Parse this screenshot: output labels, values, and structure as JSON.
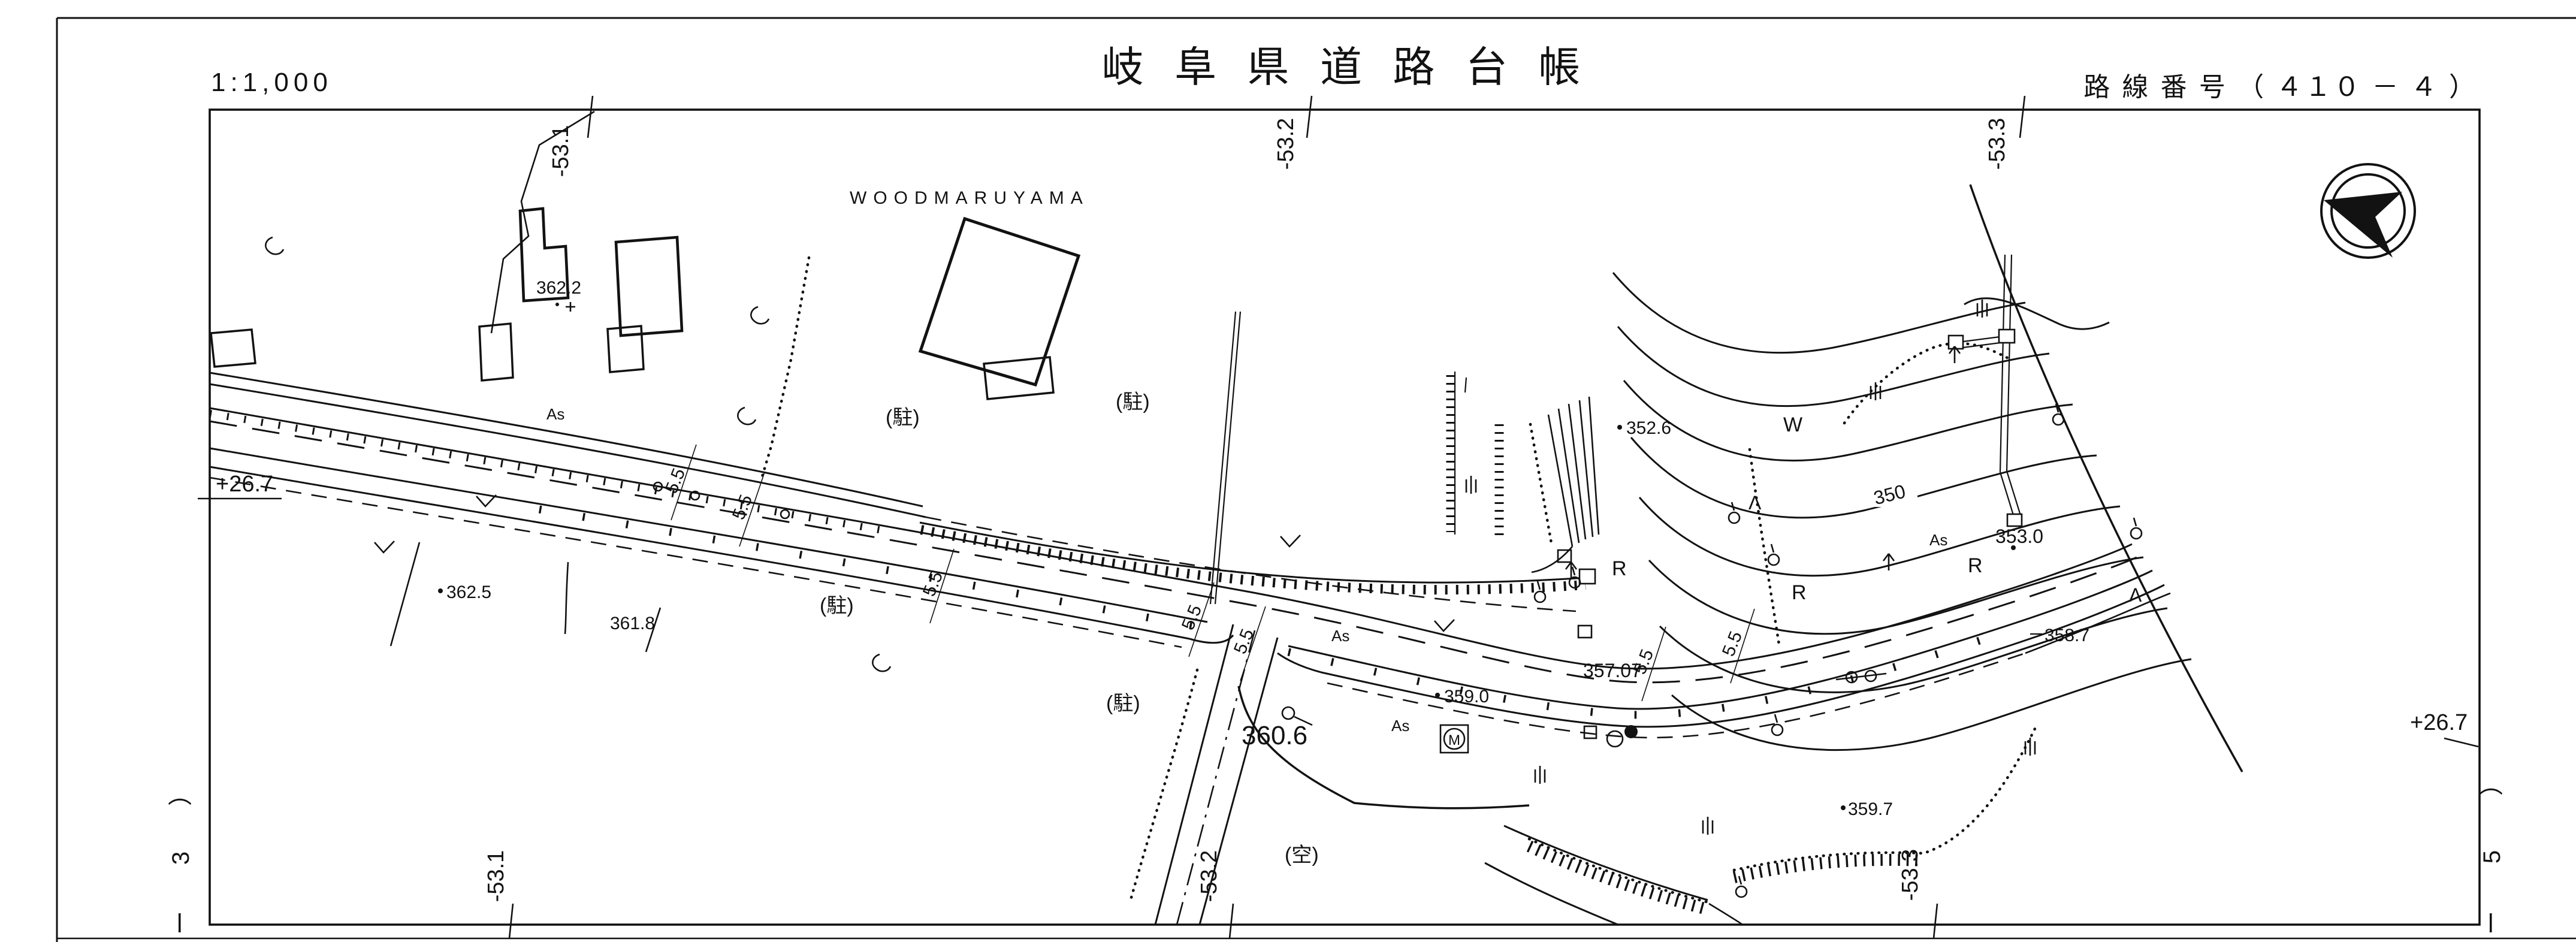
{
  "colors": {
    "ink": "#121212",
    "paper": "#ffffff"
  },
  "header": {
    "scale": "1:1,000",
    "title": "岐 阜 県 道 路 台 帳",
    "route_number": "路 線 番 号 （ ４１０ －  ４  ）"
  },
  "sheet_margin": {
    "left": {
      "c1": "）",
      "c2": "3",
      "c3": "ー"
    },
    "right": {
      "c1": "）",
      "c2": "5",
      "c3": "ー"
    }
  },
  "grid": {
    "top_1": "-53.1",
    "top_2": "-53.2",
    "top_3": "-53.3",
    "bottom_1": "-53.1",
    "bottom_2": "-53.2",
    "bottom_3": "-53.3",
    "left_level": "+26.7",
    "right_level": "+26.7"
  },
  "labels": {
    "place_name": "WOODMARUYAMA",
    "parking": "(駐)",
    "vacant": "(空)",
    "pavement": "As",
    "road_width": "5.5",
    "manhole": "M",
    "contour_value": "350",
    "letter_r": "R",
    "letter_w": "W",
    "lambda": "Λ",
    "arrow_up": "↑"
  },
  "spot_heights": {
    "h362_2": "362.2",
    "h362_5": "362.5",
    "h361_8": "361.8",
    "h360_6": "360.6",
    "h359_0": "359.0",
    "h357_07": "357.07",
    "h352_6": "352.6",
    "h353_0": "353.0",
    "h358_7": "358.7",
    "h359_7": "359.7"
  }
}
